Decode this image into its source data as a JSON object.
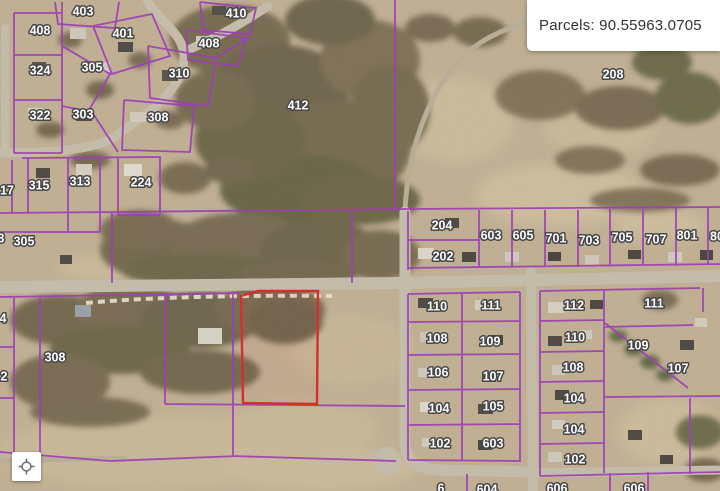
{
  "map": {
    "info_box": {
      "label": "Parcels: 90.55963.0705"
    },
    "colors": {
      "parcel_boundary": "#9c3fb5",
      "selected_parcel": "#d32f2f"
    },
    "selected_parcel_points": "241,296 258,291 318,291 317,404 243,403",
    "parcel_labels": [
      {
        "text": "403",
        "x": 83,
        "y": 11
      },
      {
        "text": "410",
        "x": 236,
        "y": 13
      },
      {
        "text": "408",
        "x": 40,
        "y": 30
      },
      {
        "text": "401",
        "x": 123,
        "y": 33
      },
      {
        "text": "408",
        "x": 209,
        "y": 43
      },
      {
        "text": "324",
        "x": 40,
        "y": 70
      },
      {
        "text": "305",
        "x": 92,
        "y": 67
      },
      {
        "text": "310",
        "x": 179,
        "y": 73
      },
      {
        "text": "208",
        "x": 613,
        "y": 74
      },
      {
        "text": "412",
        "x": 298,
        "y": 105
      },
      {
        "text": "322",
        "x": 40,
        "y": 115
      },
      {
        "text": "303",
        "x": 83,
        "y": 114
      },
      {
        "text": "308",
        "x": 158,
        "y": 117
      },
      {
        "text": "17",
        "x": 7,
        "y": 190
      },
      {
        "text": "315",
        "x": 39,
        "y": 185
      },
      {
        "text": "313",
        "x": 80,
        "y": 181
      },
      {
        "text": "224",
        "x": 141,
        "y": 182
      },
      {
        "text": "204",
        "x": 442,
        "y": 225
      },
      {
        "text": "603",
        "x": 491,
        "y": 235
      },
      {
        "text": "605",
        "x": 523,
        "y": 235
      },
      {
        "text": "701",
        "x": 556,
        "y": 238
      },
      {
        "text": "703",
        "x": 589,
        "y": 240
      },
      {
        "text": "705",
        "x": 622,
        "y": 237
      },
      {
        "text": "707",
        "x": 656,
        "y": 239
      },
      {
        "text": "801",
        "x": 687,
        "y": 235
      },
      {
        "text": "80",
        "x": 717,
        "y": 236
      },
      {
        "text": "3",
        "x": 1,
        "y": 238
      },
      {
        "text": "305",
        "x": 24,
        "y": 241
      },
      {
        "text": "202",
        "x": 443,
        "y": 256
      },
      {
        "text": "110",
        "x": 437,
        "y": 306
      },
      {
        "text": "111",
        "x": 491,
        "y": 305
      },
      {
        "text": "112",
        "x": 574,
        "y": 305
      },
      {
        "text": "111",
        "x": 654,
        "y": 303
      },
      {
        "text": "4",
        "x": 3,
        "y": 318
      },
      {
        "text": "108",
        "x": 437,
        "y": 338
      },
      {
        "text": "109",
        "x": 490,
        "y": 341
      },
      {
        "text": "110",
        "x": 575,
        "y": 337
      },
      {
        "text": "109",
        "x": 638,
        "y": 345
      },
      {
        "text": "308",
        "x": 55,
        "y": 357
      },
      {
        "text": "108",
        "x": 573,
        "y": 367
      },
      {
        "text": "107",
        "x": 678,
        "y": 368
      },
      {
        "text": "106",
        "x": 438,
        "y": 372
      },
      {
        "text": "107",
        "x": 493,
        "y": 376
      },
      {
        "text": "2",
        "x": 4,
        "y": 376
      },
      {
        "text": "104",
        "x": 574,
        "y": 398
      },
      {
        "text": "104",
        "x": 439,
        "y": 408
      },
      {
        "text": "105",
        "x": 493,
        "y": 406
      },
      {
        "text": "104",
        "x": 574,
        "y": 429
      },
      {
        "text": "102",
        "x": 440,
        "y": 443
      },
      {
        "text": "603",
        "x": 493,
        "y": 443
      },
      {
        "text": "102",
        "x": 575,
        "y": 459
      },
      {
        "text": "6",
        "x": 441,
        "y": 488
      },
      {
        "text": "604",
        "x": 487,
        "y": 489
      },
      {
        "text": "606",
        "x": 557,
        "y": 488
      },
      {
        "text": "606",
        "x": 634,
        "y": 488
      }
    ]
  },
  "controls": {
    "locate_button": {
      "icon": "crosshair-locate-icon"
    }
  }
}
